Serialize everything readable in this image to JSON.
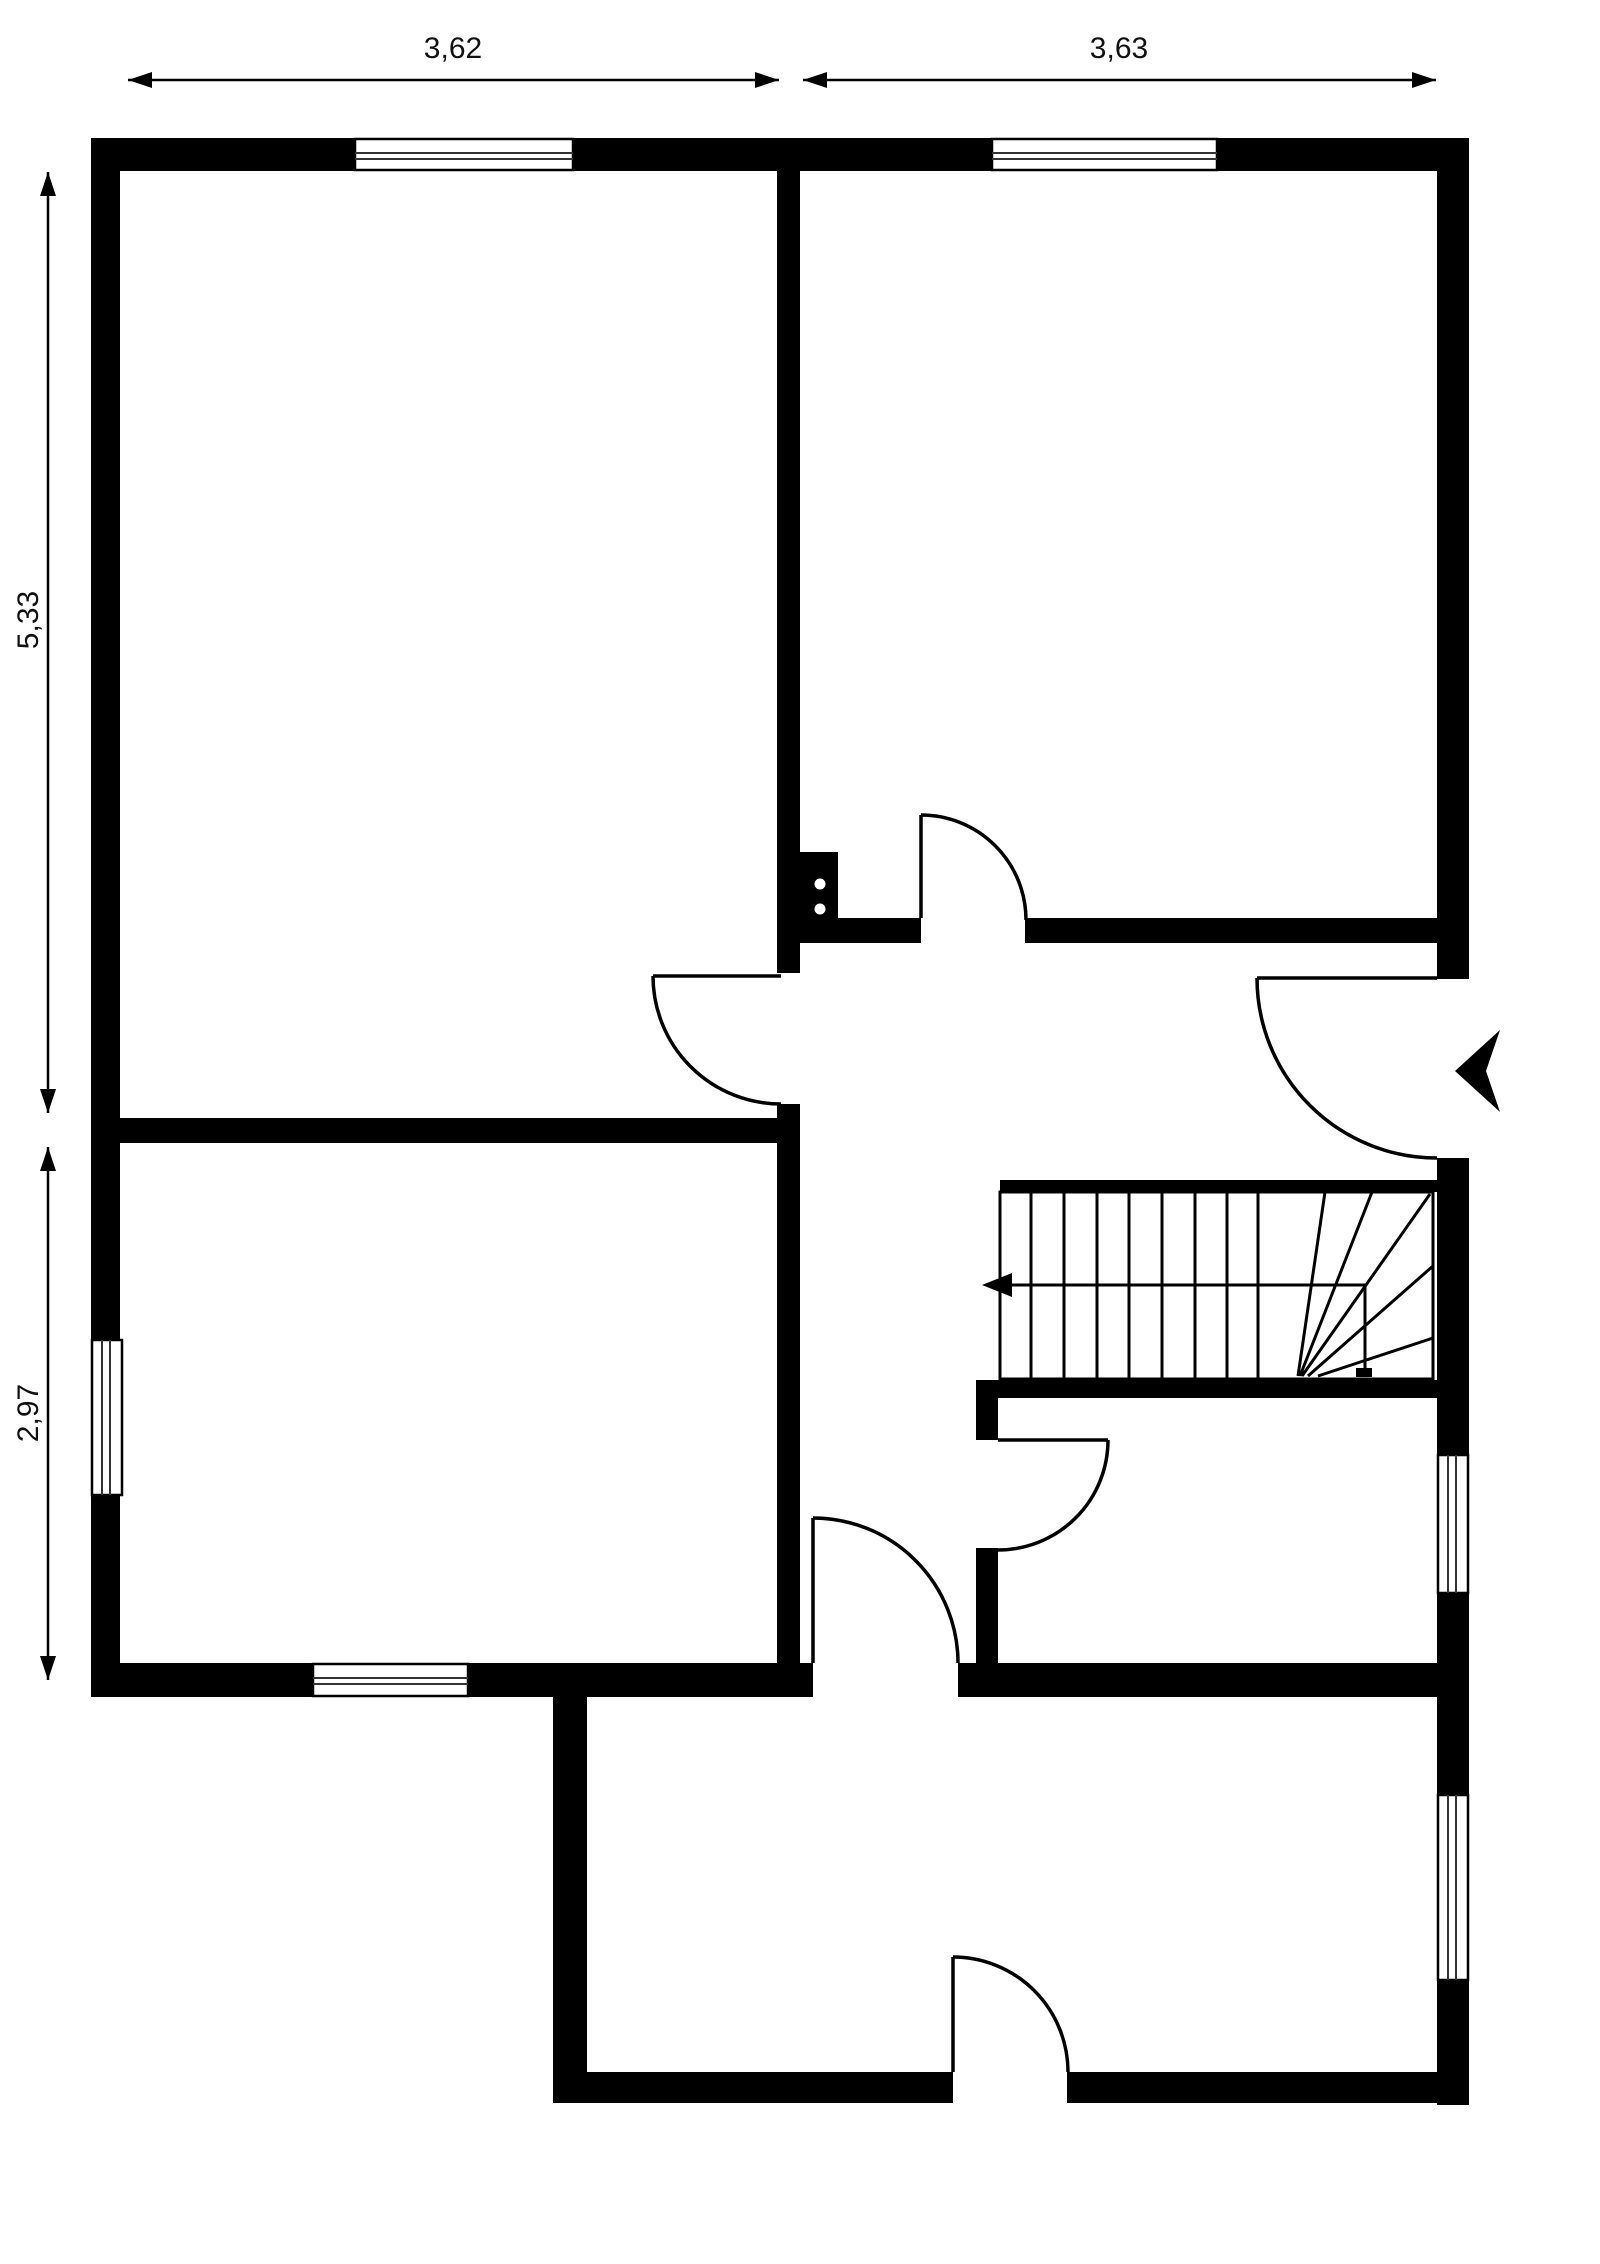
{
  "plan": {
    "type": "floor-plan",
    "dimensions": {
      "top_left": "3,62",
      "top_right": "3,63",
      "left_upper": "5,33",
      "left_lower": "2,97"
    },
    "colors": {
      "wall": "#000000",
      "background": "#ffffff",
      "annotation": "#111111"
    },
    "features": {
      "windows": 6,
      "doors": 6,
      "staircase": 1,
      "entry_arrow": "points-left-into-entry-door"
    }
  }
}
